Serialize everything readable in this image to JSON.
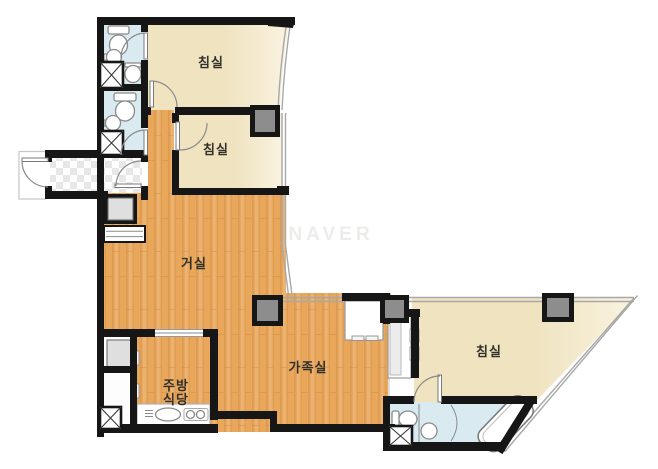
{
  "watermark": {
    "text": "NAVER"
  },
  "labels": {
    "bedroom_top": "침실",
    "bedroom_middle": "침실",
    "bedroom_right": "침실",
    "living_room": "거실",
    "family_room": "가족실",
    "kitchen_line1": "주방",
    "kitchen_line2": "식당"
  },
  "colors": {
    "wall": "#161616",
    "wood_floor": "#e9a75c",
    "wood_grain": "#c88a40",
    "bedroom_floor": "#efe3c0",
    "bedroom_floor_light": "#f9f3e0",
    "bathroom_floor": "#d9ebf1",
    "pillar": "#8d8d8d",
    "closet_gray": "#dfdfdf",
    "checker": "#e7e7e7",
    "watermark": "#edecea",
    "label_text": "#32302b",
    "fixture_line": "#8a8a8a",
    "window_line": "#a8a8a8"
  }
}
